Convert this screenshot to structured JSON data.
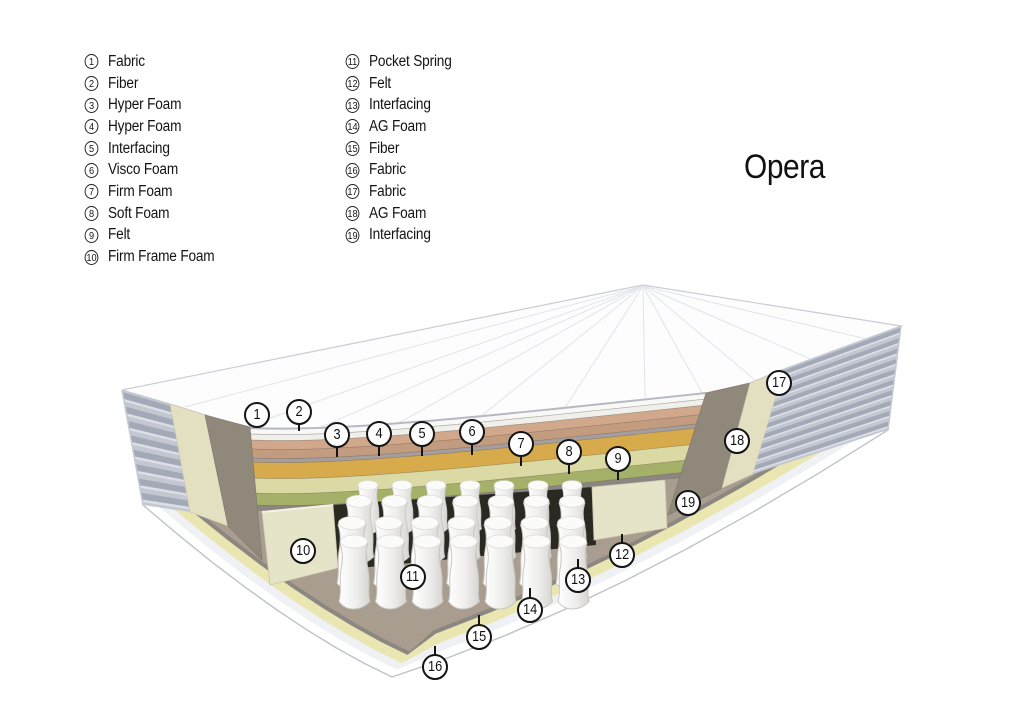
{
  "title": "Opera",
  "legend": {
    "column1": [
      {
        "num": "1",
        "label": "Fabric"
      },
      {
        "num": "2",
        "label": "Fiber"
      },
      {
        "num": "3",
        "label": "Hyper Foam"
      },
      {
        "num": "4",
        "label": "Hyper Foam"
      },
      {
        "num": "5",
        "label": "Interfacing"
      },
      {
        "num": "6",
        "label": "Visco Foam"
      },
      {
        "num": "7",
        "label": "Firm Foam"
      },
      {
        "num": "8",
        "label": "Soft Foam"
      },
      {
        "num": "9",
        "label": "Felt"
      },
      {
        "num": "10",
        "label": "Firm Frame Foam"
      }
    ],
    "column2": [
      {
        "num": "11",
        "label": "Pocket Spring"
      },
      {
        "num": "12",
        "label": "Felt"
      },
      {
        "num": "13",
        "label": "Interfacing"
      },
      {
        "num": "14",
        "label": "AG Foam"
      },
      {
        "num": "15",
        "label": "Fiber"
      },
      {
        "num": "16",
        "label": "Fabric"
      },
      {
        "num": "17",
        "label": "Fabric"
      },
      {
        "num": "18",
        "label": "AG Foam"
      },
      {
        "num": "19",
        "label": "Interfacing"
      }
    ]
  },
  "diagram": {
    "callouts": [
      {
        "num": "1",
        "x": 257,
        "y": 415,
        "tick": "none",
        "len": 0
      },
      {
        "num": "2",
        "x": 299,
        "y": 412,
        "tick": "down",
        "len": 8
      },
      {
        "num": "3",
        "x": 337,
        "y": 435,
        "tick": "down",
        "len": 11
      },
      {
        "num": "4",
        "x": 379,
        "y": 434,
        "tick": "down",
        "len": 11
      },
      {
        "num": "5",
        "x": 422,
        "y": 434,
        "tick": "down",
        "len": 11
      },
      {
        "num": "6",
        "x": 472,
        "y": 432,
        "tick": "down",
        "len": 12
      },
      {
        "num": "7",
        "x": 521,
        "y": 444,
        "tick": "down",
        "len": 11
      },
      {
        "num": "8",
        "x": 569,
        "y": 452,
        "tick": "down",
        "len": 11
      },
      {
        "num": "9",
        "x": 618,
        "y": 459,
        "tick": "down",
        "len": 10
      },
      {
        "num": "10",
        "x": 303,
        "y": 551,
        "tick": "none",
        "len": 0
      },
      {
        "num": "11",
        "x": 413,
        "y": 577,
        "tick": "none",
        "len": 0
      },
      {
        "num": "12",
        "x": 622,
        "y": 555,
        "tick": "up",
        "len": 10
      },
      {
        "num": "13",
        "x": 578,
        "y": 580,
        "tick": "up",
        "len": 10
      },
      {
        "num": "14",
        "x": 530,
        "y": 610,
        "tick": "up",
        "len": 11
      },
      {
        "num": "15",
        "x": 479,
        "y": 637,
        "tick": "up",
        "len": 11
      },
      {
        "num": "16",
        "x": 435,
        "y": 667,
        "tick": "up",
        "len": 10
      },
      {
        "num": "17",
        "x": 779,
        "y": 383,
        "tick": "none",
        "len": 0
      },
      {
        "num": "18",
        "x": 737,
        "y": 441,
        "tick": "none",
        "len": 0
      },
      {
        "num": "19",
        "x": 688,
        "y": 503,
        "tick": "none",
        "len": 0
      }
    ],
    "stack": [
      {
        "num": "1",
        "name": "Fabric",
        "color": "#f8f8f6",
        "t": 6
      },
      {
        "num": "2",
        "name": "Fiber",
        "color": "#efefeb",
        "t": 6
      },
      {
        "num": "3",
        "name": "Hyper Foam",
        "color": "#d1a88b",
        "t": 9
      },
      {
        "num": "4",
        "name": "Hyper Foam",
        "color": "#c39c80",
        "t": 9
      },
      {
        "num": "5",
        "name": "Interfacing",
        "color": "#a59e9f",
        "t": 4
      },
      {
        "num": "6",
        "name": "Visco Foam",
        "color": "#d7aa4c",
        "t": 16
      },
      {
        "num": "7",
        "name": "Firm Foam",
        "color": "#dcdaa4",
        "t": 15
      },
      {
        "num": "8",
        "name": "Soft Foam",
        "color": "#a5b068",
        "t": 12
      },
      {
        "num": "9",
        "name": "Felt",
        "color": "#8b8681",
        "t": 5
      }
    ],
    "bottom_strips": [
      {
        "num": "16",
        "name": "Fabric",
        "color": "#ffffff",
        "inset": 0
      },
      {
        "num": "15",
        "name": "Fiber",
        "color": "#eff1f5",
        "inset": 9
      },
      {
        "num": "14",
        "name": "AG Foam",
        "color": "#e9e6b2",
        "inset": 17
      },
      {
        "num": "13",
        "name": "Interfacing",
        "color": "#8d8781",
        "inset": 27
      },
      {
        "num": "12",
        "name": "Felt",
        "color": "#a89d8f",
        "inset": 31
      }
    ],
    "colors": {
      "top_fabric": "#fdfdfe",
      "outline": "#c9ccd4",
      "quilt_line": "#e2e4eb",
      "side_fabric_base": "#c3c7d1",
      "side_fabric_ridge": "#9da3b3",
      "side_fabric_light": "#dcdfe6",
      "border_cream": "#e2e0c0",
      "border_brown": "#90887b",
      "frame_foam": "#e6e4c8",
      "cavity": "#2c2923",
      "felt_base": "#a89d8f",
      "spring_light": "#ffffff",
      "spring_dark": "#d7d5d1"
    }
  }
}
